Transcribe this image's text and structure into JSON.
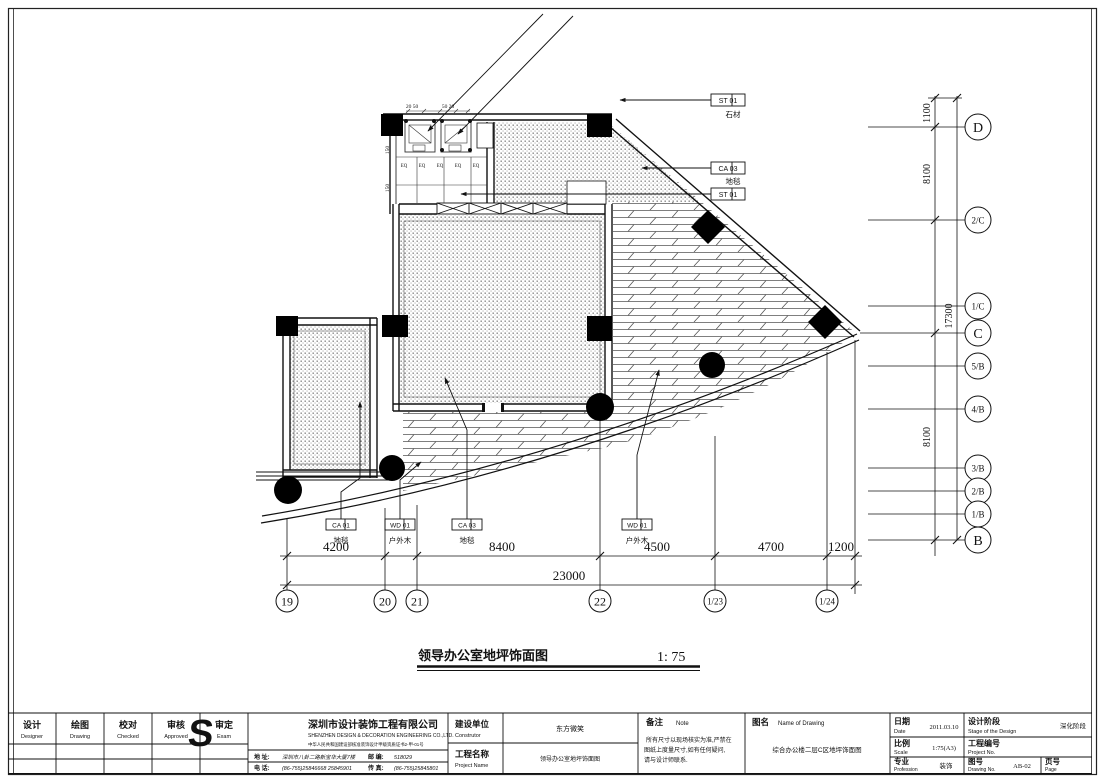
{
  "drawing": {
    "title": "领导办公室地坪饰面图",
    "scale_label": "1: 75",
    "floor_labels": [
      {
        "code": "ST 01",
        "name": "石材"
      },
      {
        "code": "CA 03",
        "name": "地毯"
      },
      {
        "code": "ST 01",
        "name": ""
      },
      {
        "code": "CA 01",
        "name": "地毯"
      },
      {
        "code": "WD 01",
        "name": "户外木"
      },
      {
        "code": "CA 03",
        "name": "地毯"
      },
      {
        "code": "WD 01",
        "name": "户外木"
      }
    ],
    "dims_bottom": [
      "4200",
      "8400",
      "4500",
      "4700",
      "1200"
    ],
    "dim_total": "23000",
    "dims_right": [
      "1100",
      "8100",
      "17300",
      "8100"
    ],
    "grid_bottom": [
      "19",
      "20",
      "21",
      "22",
      "1/23",
      "1/24"
    ],
    "grid_right": [
      "D",
      "2/C",
      "1/C",
      "C",
      "5/B",
      "4/B",
      "3/B",
      "2/B",
      "1/B",
      "B"
    ],
    "detail": {
      "dim_a": "20 50",
      "dim_b": "50 20",
      "dim_side": "150",
      "eq": [
        "EQ",
        "EQ",
        "EQ",
        "EQ",
        "EQ"
      ]
    }
  },
  "titleblock": {
    "signoff": [
      {
        "cn": "设计",
        "en": "Designer"
      },
      {
        "cn": "绘图",
        "en": "Drawing"
      },
      {
        "cn": "校对",
        "en": "Checked"
      },
      {
        "cn": "审核",
        "en": "Approved"
      },
      {
        "cn": "审定",
        "en": "Exam"
      }
    ],
    "company": {
      "logo": "S",
      "name_cn": "深圳市设计装饰工程有限公司",
      "name_en": "SHENZHEN DESIGN & DECORATION ENGINEERING CO.,LTD.",
      "cert": "中华人民共和国建设部核准装饰设计甲级资质证书2-甲-01号",
      "addr_label": "地 址:",
      "addr": "深圳市八卦二路新宝华大厦7楼",
      "zip_label": "邮 编:",
      "zip": "518029",
      "tel_label": "电 话:",
      "tel": "(86-755)25846668 25845901",
      "fax_label": "传 真:",
      "fax": "(86-755)25845801"
    },
    "constructor": {
      "cn": "建设单位",
      "en": "Construtor",
      "value": "东方微笑"
    },
    "project": {
      "cn": "工程名称",
      "en": "Project Name",
      "value": "领导办公室地坪饰面图"
    },
    "note": {
      "cn": "备注",
      "en": "Note",
      "lines": [
        "所有尺寸以现场核实为准,严禁在",
        "图纸上度量尺寸,如有任何疑问,",
        "请与设计师联系."
      ]
    },
    "drawing_name": {
      "cn": "图名",
      "en": "Name of Drawing",
      "value": "综合办公楼二层C区地坪饰面图"
    },
    "date": {
      "cn": "日期",
      "en": "Date",
      "value": "2011.03.10"
    },
    "stage": {
      "cn": "设计阶段",
      "en": "Stage of the Design",
      "value": "深化阶段"
    },
    "scale": {
      "cn": "比例",
      "en": "Scale",
      "value": "1:75(A3)"
    },
    "project_no": {
      "cn": "工程编号",
      "en": "Project No.",
      "value": ""
    },
    "profession": {
      "cn": "专业",
      "en": "Profession",
      "value": "装饰"
    },
    "drawing_no": {
      "cn": "图号",
      "en": "Drawing No.",
      "value": "AB-02"
    },
    "page": {
      "cn": "页号",
      "en": "Page",
      "value": ""
    }
  }
}
